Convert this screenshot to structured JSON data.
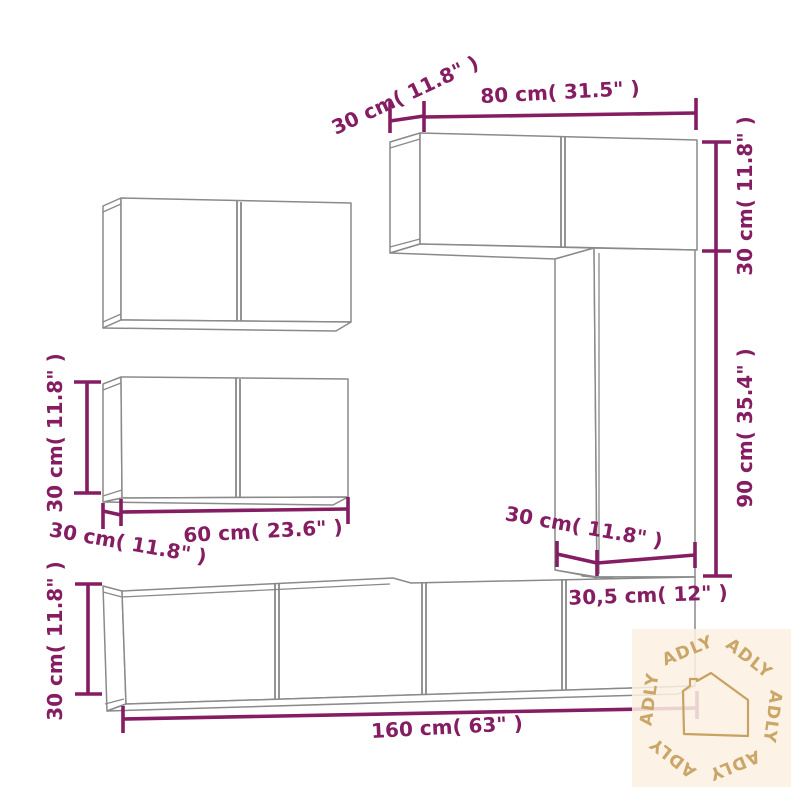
{
  "colors": {
    "dimension_annotation": "#851d62",
    "cabinet_outline": "#8a8a8a",
    "watermark_background": "#fcf0e2",
    "watermark_accent": "#c8a262"
  },
  "dimensions": {
    "top_wall_cabinet": {
      "depth": "30 cm( 11.8\" )",
      "width": "80 cm( 31.5\" )",
      "height": "30 cm( 11.8\" )"
    },
    "tall_wall_cabinet": {
      "height": "90 cm( 35.4\" )",
      "depth": "30 cm( 11.8\" )",
      "width": "30,5 cm( 12\" )"
    },
    "left_wall_cabinet": {
      "height": "30 cm( 11.8\" )",
      "width": "60 cm( 23.6\" )",
      "depth": "30 cm( 11.8\" )"
    },
    "tv_stand": {
      "height": "30 cm( 11.8\" )",
      "width": "160 cm( 63\" )"
    }
  },
  "watermark": {
    "brand": "ADLY"
  }
}
